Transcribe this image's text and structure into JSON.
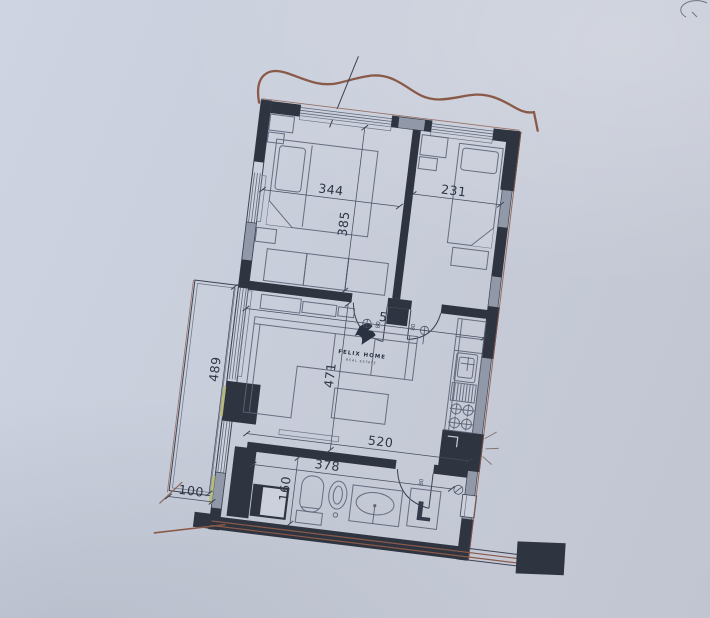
{
  "photo": {
    "paper_color": "#c8cdd9",
    "ink_color": "#3c4353",
    "wall_fill": "#2e3440",
    "pier_fill": "#9198a8",
    "glass_color": "#5f6878",
    "accent_red": "#8a5a48",
    "accent_green": "#b6ba7e"
  },
  "plan": {
    "logo": {
      "title": "FELIX HOME",
      "subtitle": "REAL ESTATE"
    },
    "dims": {
      "bedroom1_width": "344",
      "bedroom1_depth": "385",
      "bedroom2_width": "231",
      "living_width": "543",
      "living_depth": "471",
      "balcony_length": "489",
      "balcony_depth": "100",
      "lower_width": "520",
      "bath_width": "378",
      "bath_depth": "160"
    },
    "labels": {
      "washing_machine": "L",
      "door_bedroom1_size": "80",
      "door_bedroom2_size": "80",
      "door_bath_size": "80"
    }
  }
}
